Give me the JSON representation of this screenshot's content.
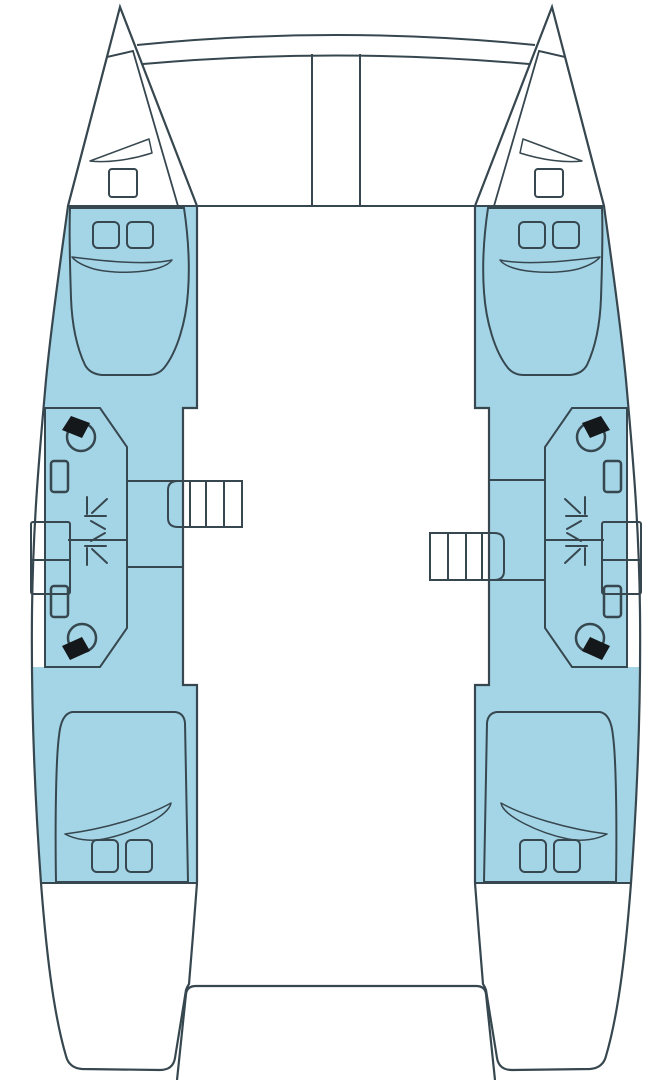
{
  "title": "Catamaran deck and cabin layout plan (top view)",
  "colors": {
    "background": "#ffffff",
    "outline": "#37474f",
    "hull_interior": "#a4d5e7",
    "berth": "#7db2c6",
    "foredeck": "#b7c8cd",
    "bathroom": "#c6d687",
    "stairs": "#fbc971",
    "fixture_black": "#15181a",
    "white": "#ffffff"
  },
  "vessel": {
    "type": "catamaran",
    "hulls": [
      "port",
      "starboard"
    ],
    "per_hull": {
      "double_berth_cabins": 2,
      "bathrooms": 2,
      "toilets": 2,
      "sinks": 2,
      "shower_trays": 2,
      "companionway_treads": 4,
      "bow_hatches": 2,
      "cabin_hatches_per_cabin": 2,
      "hull_window_panes": 2
    },
    "bow_features": [
      "trampoline",
      "forward-crossbeam",
      "center-walkway"
    ],
    "stern_features": [
      "aft-cockpit-platform",
      "twin-transoms"
    ]
  }
}
